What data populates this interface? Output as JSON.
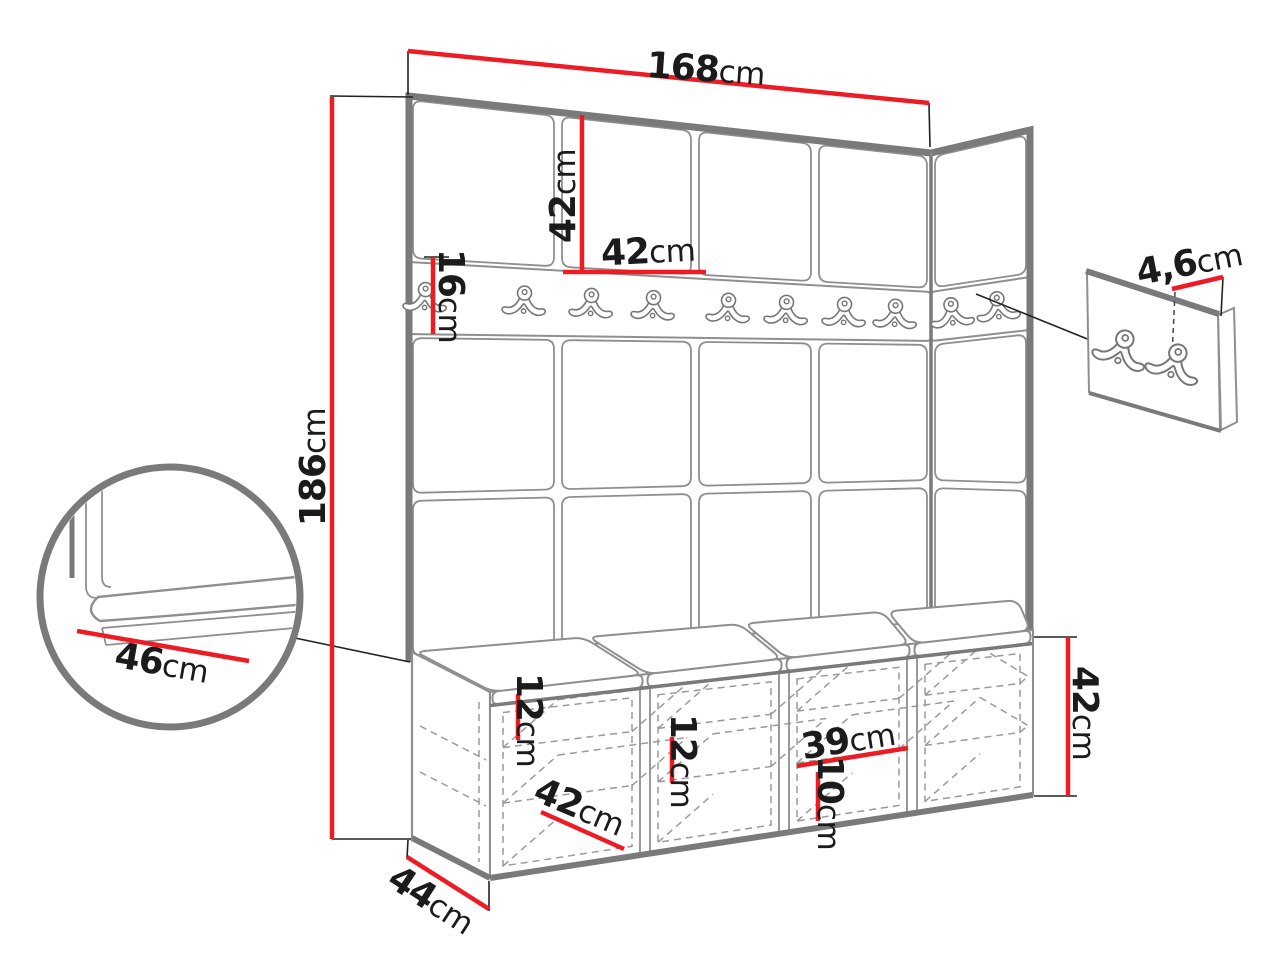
{
  "diagram": {
    "kind": "furniture-dimension-drawing",
    "background": "#ffffff"
  },
  "colors": {
    "dimension_red": "#ed1c24",
    "drawing_gray": "#7a7a7a",
    "label_black": "#1b1b1b"
  },
  "wall_unit": {
    "front_panel_columns": 4,
    "side_panel_columns": 1,
    "panel_rows": 3,
    "front_hooks": 8,
    "side_hooks": 2
  },
  "bench": {
    "compartments": 4,
    "cushions": 4,
    "shelves_per_compartment": 2
  },
  "detail_panel": {
    "hooks": 2
  },
  "dimensions": {
    "total_width": {
      "value": "168",
      "unit": "cm"
    },
    "panel_height": {
      "value": "42",
      "unit": "cm"
    },
    "panel_width": {
      "value": "42",
      "unit": "cm"
    },
    "rail_height": {
      "value": "16",
      "unit": "cm"
    },
    "total_height": {
      "value": "186",
      "unit": "cm"
    },
    "panel_thickness": {
      "value": "4,6",
      "unit": "cm"
    },
    "seat_depth": {
      "value": "46",
      "unit": "cm"
    },
    "bench_depth": {
      "value": "44",
      "unit": "cm"
    },
    "compartment_width": {
      "value": "42",
      "unit": "cm"
    },
    "shelf_spacing_left": {
      "value": "12",
      "unit": "cm"
    },
    "shelf_spacing_mid": {
      "value": "12",
      "unit": "cm"
    },
    "compartment_inner_width": {
      "value": "39",
      "unit": "cm"
    },
    "shelf_spacing_right": {
      "value": "10",
      "unit": "cm"
    },
    "bench_height": {
      "value": "42",
      "unit": "cm"
    }
  }
}
